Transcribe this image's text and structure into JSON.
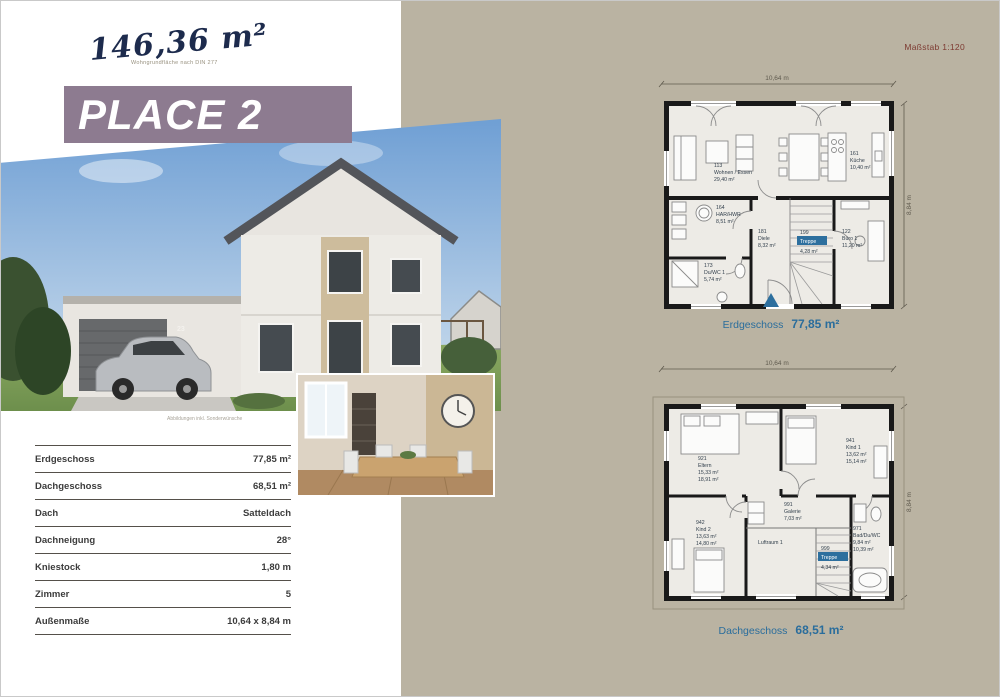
{
  "header": {
    "area_value": "146,36 m²",
    "area_note": "Wohngrundfläche nach DIN 277",
    "title": "PLACE 2",
    "scale_label": "Maßstab 1:120"
  },
  "photo": {
    "house_number": "23",
    "disclaimer": "Abbildungen inkl. Sonderwünsche"
  },
  "specs": {
    "rows": [
      {
        "label": "Erdgeschoss",
        "value": "77,85 m²"
      },
      {
        "label": "Dachgeschoss",
        "value": "68,51 m²"
      },
      {
        "label": "Dach",
        "value": "Satteldach"
      },
      {
        "label": "Dachneigung",
        "value": "28°"
      },
      {
        "label": "Kniestock",
        "value": "1,80 m"
      },
      {
        "label": "Zimmer",
        "value": "5"
      },
      {
        "label": "Außenmaße",
        "value": "10,64 x 8,84 m"
      }
    ]
  },
  "plans": {
    "eg": {
      "name": "Erdgeschoss",
      "area": "77,85 m²",
      "width_label": "10,64 m",
      "height_label": "8,84 m",
      "rooms": [
        {
          "id": "113",
          "name": "Wohnen / Essen",
          "area": "29,40 m²"
        },
        {
          "id": "161",
          "name": "Küche",
          "area": "10,40 m²"
        },
        {
          "id": "164",
          "name": "HAR/HWR",
          "area": "8,51 m²"
        },
        {
          "id": "173",
          "name": "Du/WC 1",
          "area": "5,74 m²"
        },
        {
          "id": "181",
          "name": "Diele",
          "area": "8,32 m²"
        },
        {
          "id": "199",
          "name": "Treppe",
          "area": "4,28 m²"
        },
        {
          "id": "122",
          "name": "Büro 1",
          "area": "11,20 m²"
        }
      ]
    },
    "dg": {
      "name": "Dachgeschoss",
      "area": "68,51 m²",
      "width_label": "10,64 m",
      "height_label": "8,84 m",
      "rooms": [
        {
          "id": "921",
          "name": "Eltern",
          "area": "15,33 m²",
          "area2": "18,91 m²"
        },
        {
          "id": "941",
          "name": "Kind 1",
          "area": "13,62 m²",
          "area2": "15,14 m²"
        },
        {
          "id": "991",
          "name": "Galerie",
          "area": "7,03 m²"
        },
        {
          "id": "942",
          "name": "Kind 2",
          "area": "13,63 m²",
          "area2": "14,80 m²"
        },
        {
          "id": "",
          "name": "Luftraum 1"
        },
        {
          "id": "999",
          "name": "Treppe",
          "area": "4,34 m²"
        },
        {
          "id": "971",
          "name": "Bad/Du/WC",
          "area": "9,84 m²",
          "area2": "10,39 m²"
        }
      ]
    }
  }
}
